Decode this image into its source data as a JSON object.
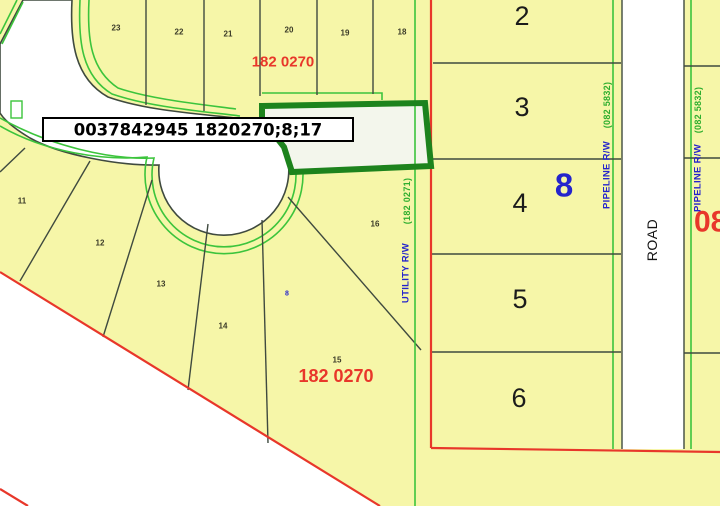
{
  "map": {
    "selected_parcel_tip": "0037842945 1820270;8;17",
    "plan_label_top": "182 0270",
    "plan_label_bottom": "182 0270",
    "block_number_blue": "8",
    "small_blue_label": "8",
    "clipped_plan_red": "08",
    "road_label": "ROAD",
    "pipeline_left": {
      "rw": "PIPELINE R/W",
      "plan": "(082 5832)"
    },
    "pipeline_right": {
      "rw": "PIPELINE R/W",
      "plan": "(082 5832)"
    },
    "utility": {
      "rw": "UTILITY R/W",
      "plan": "(182 0271)"
    },
    "lots_top": [
      "23",
      "22",
      "21",
      "20",
      "19",
      "18"
    ],
    "lots_right": [
      "2",
      "3",
      "4",
      "5",
      "6"
    ],
    "lots_inner": [
      "11",
      "12",
      "13",
      "14",
      "15",
      "16"
    ]
  },
  "colors": {
    "parcel_fill": "#f6f6a8",
    "road_fill": "#ffffff",
    "selected_fill": "#f3f6ec",
    "selected_outline": "#1d831d",
    "rw_green": "#3cc43c",
    "boundary_red": "#e8372a",
    "parcel_line": "#3f4a3f",
    "annotation_blue": "#2424cc"
  }
}
